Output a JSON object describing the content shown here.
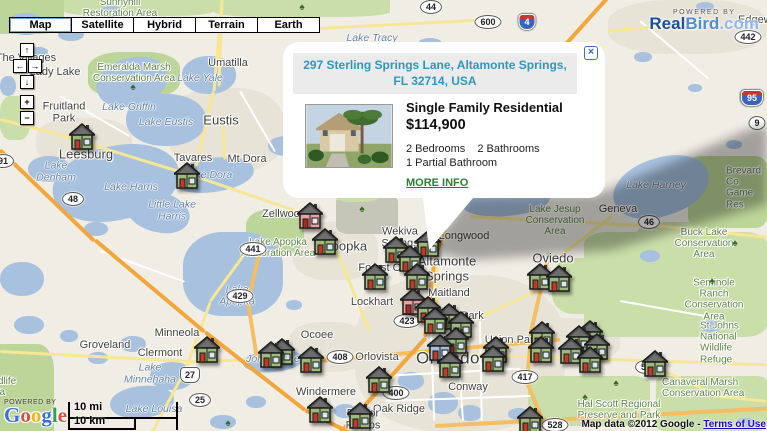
{
  "header": {
    "map_types": [
      "Map",
      "Satellite",
      "Hybrid",
      "Terrain",
      "Earth"
    ],
    "selected_map_type": "Map"
  },
  "controls": {
    "pan_up": "↑",
    "pan_left": "←",
    "pan_right": "→",
    "pan_down": "↓",
    "zoom_in": "+",
    "zoom_out": "−"
  },
  "infowindow": {
    "address": "297 Sterling Springs Lane, Altamonte Springs, FL 32714, USA",
    "close": "×",
    "property_type": "Single Family Residential",
    "price": "$114,900",
    "bedrooms": "2 Bedrooms",
    "bathrooms": "2 Bathrooms",
    "partial_bath": "1 Partial Bathroom",
    "more_info": "MORE INFO"
  },
  "branding": {
    "realbird": {
      "powered_by": "POWERED BY",
      "real": "Real",
      "bird": "Bird",
      "com": ".com"
    },
    "google": {
      "powered_by": "POWERED BY",
      "letters": [
        {
          "ch": "G",
          "color": "#3B6FD4"
        },
        {
          "ch": "o",
          "color": "#D95040"
        },
        {
          "ch": "o",
          "color": "#F2B50F"
        },
        {
          "ch": "g",
          "color": "#3B6FD4"
        },
        {
          "ch": "l",
          "color": "#30A055"
        },
        {
          "ch": "e",
          "color": "#D95040"
        }
      ]
    }
  },
  "scale": {
    "miles": "10 mi",
    "km": "10 km"
  },
  "attribution": {
    "text": "Map data ©2012 Google - ",
    "terms": "Terms of Use"
  },
  "map": {
    "labels": [
      {
        "text": "The Villages",
        "type": "city",
        "x": 26,
        "y": 58
      },
      {
        "text": "Sunnyhill\nRestoration Area",
        "type": "park",
        "x": 120,
        "y": 8
      },
      {
        "text": "Lady Lake",
        "type": "city",
        "x": 55,
        "y": 72
      },
      {
        "text": "Umatilla",
        "type": "city",
        "x": 228,
        "y": 63
      },
      {
        "text": "Emeralda Marsh\nConservation Area",
        "type": "park",
        "x": 134,
        "y": 73
      },
      {
        "text": "Lake Yale",
        "type": "water",
        "x": 200,
        "y": 79
      },
      {
        "text": "Lake Tracy",
        "type": "water",
        "x": 372,
        "y": 39
      },
      {
        "text": "Edgewater",
        "type": "city",
        "x": 738,
        "y": 20,
        "anchor": "left"
      },
      {
        "text": "Fruitland\nPark",
        "type": "city",
        "x": 64,
        "y": 113
      },
      {
        "text": "Lake Griffin",
        "type": "water",
        "x": 129,
        "y": 108
      },
      {
        "text": "Lake Eustis",
        "type": "water",
        "x": 166,
        "y": 123
      },
      {
        "text": "Eustis",
        "type": "city-big",
        "x": 221,
        "y": 121
      },
      {
        "text": "Leesburg",
        "type": "city-big",
        "x": 86,
        "y": 155
      },
      {
        "text": "Tavares",
        "type": "city",
        "x": 193,
        "y": 158
      },
      {
        "text": "Mt Dora",
        "type": "city",
        "x": 247,
        "y": 159
      },
      {
        "text": "Lake Dora",
        "type": "water",
        "x": 208,
        "y": 176
      },
      {
        "text": "Lake\nDenham",
        "type": "water",
        "x": 56,
        "y": 172
      },
      {
        "text": "Lake Harris",
        "type": "water",
        "x": 131,
        "y": 188
      },
      {
        "text": "Little Lake\nHarris",
        "type": "water",
        "x": 172,
        "y": 211
      },
      {
        "text": "Zellwood",
        "type": "city",
        "x": 284,
        "y": 214
      },
      {
        "text": "Lake Harney",
        "type": "water",
        "x": 656,
        "y": 186
      },
      {
        "text": "Geneva",
        "type": "city",
        "x": 618,
        "y": 209
      },
      {
        "text": "Lake Jesup\nConservation\nArea",
        "type": "park",
        "x": 555,
        "y": 221
      },
      {
        "text": "Brevard Co\nGame Res",
        "type": "park",
        "x": 726,
        "y": 188,
        "anchor": "left"
      },
      {
        "text": "Buck Lake\nConservation\nArea",
        "type": "park",
        "x": 704,
        "y": 244
      },
      {
        "text": "Wekiva\nSprings",
        "type": "city",
        "x": 400,
        "y": 238
      },
      {
        "text": "Longwood",
        "type": "city",
        "x": 464,
        "y": 236
      },
      {
        "text": "Apopka",
        "type": "city-big",
        "x": 345,
        "y": 247
      },
      {
        "text": "Lake Apopka\nRestoration Area",
        "type": "park",
        "x": 278,
        "y": 248
      },
      {
        "text": "Altamonte\nSprings",
        "type": "city-big",
        "x": 447,
        "y": 269
      },
      {
        "text": "Forest City",
        "type": "city",
        "x": 385,
        "y": 268
      },
      {
        "text": "Oviedo",
        "type": "city-big",
        "x": 553,
        "y": 259
      },
      {
        "text": "Lake\nApopka",
        "type": "water",
        "x": 237,
        "y": 296
      },
      {
        "text": "Maitland",
        "type": "city",
        "x": 449,
        "y": 293
      },
      {
        "text": "Lockhart",
        "type": "city",
        "x": 372,
        "y": 302
      },
      {
        "text": "Seminole Ranch\nConservation Area",
        "type": "park",
        "x": 714,
        "y": 300
      },
      {
        "text": "Winter Park",
        "type": "city",
        "x": 455,
        "y": 316
      },
      {
        "text": "Minneola",
        "type": "city",
        "x": 177,
        "y": 333
      },
      {
        "text": "Ocoee",
        "type": "city",
        "x": 317,
        "y": 335
      },
      {
        "text": "Union Park",
        "type": "city",
        "x": 512,
        "y": 340
      },
      {
        "text": "Bithlo",
        "type": "city",
        "x": 594,
        "y": 345
      },
      {
        "text": "St Johns National\nWildlife Refuge",
        "type": "park",
        "x": 700,
        "y": 343,
        "anchor": "left"
      },
      {
        "text": "Groveland",
        "type": "city",
        "x": 105,
        "y": 345
      },
      {
        "text": "Clermont",
        "type": "city",
        "x": 160,
        "y": 353
      },
      {
        "text": "Orlovista",
        "type": "city",
        "x": 377,
        "y": 357
      },
      {
        "text": "Orlando",
        "type": "city-huge",
        "x": 448,
        "y": 358
      },
      {
        "text": "Lake\nMinnehaha",
        "type": "water",
        "x": 150,
        "y": 374
      },
      {
        "text": "Johns Lake",
        "type": "water",
        "x": 273,
        "y": 360
      },
      {
        "text": "Windermere",
        "type": "city",
        "x": 326,
        "y": 392
      },
      {
        "text": "Conway",
        "type": "city",
        "x": 468,
        "y": 387
      },
      {
        "text": "Oak Ridge",
        "type": "city",
        "x": 399,
        "y": 409
      },
      {
        "text": "Doctor\nPhillips",
        "type": "city",
        "x": 363,
        "y": 420
      },
      {
        "text": "Lake Louisa",
        "type": "water",
        "x": 154,
        "y": 410
      },
      {
        "text": "Hal Scott Regional\nPreserve and Park",
        "type": "park",
        "x": 619,
        "y": 410
      },
      {
        "text": "Canaveral Marsh\nConservation Area",
        "type": "park",
        "x": 662,
        "y": 388,
        "anchor": "left"
      },
      {
        "text": "Wildlife\nArea",
        "type": "park",
        "x": -16,
        "y": 387,
        "anchor": "left"
      }
    ],
    "shields": [
      {
        "label": "44",
        "kind": "oval",
        "x": 431,
        "y": 7
      },
      {
        "label": "600",
        "kind": "oval",
        "x": 488,
        "y": 22
      },
      {
        "label": "4",
        "kind": "interstate",
        "x": 527,
        "y": 22
      },
      {
        "label": "442",
        "kind": "oval",
        "x": 748,
        "y": 37
      },
      {
        "label": "95",
        "kind": "interstate",
        "x": 752,
        "y": 98
      },
      {
        "label": "9",
        "kind": "oval",
        "x": 757,
        "y": 123
      },
      {
        "label": "91",
        "kind": "oval",
        "x": 3,
        "y": 161
      },
      {
        "label": "48",
        "kind": "oval",
        "x": 73,
        "y": 199
      },
      {
        "label": "441",
        "kind": "oval",
        "x": 253,
        "y": 249
      },
      {
        "label": "429",
        "kind": "oval",
        "x": 240,
        "y": 296
      },
      {
        "label": "46",
        "kind": "oval",
        "x": 649,
        "y": 222
      },
      {
        "label": "423",
        "kind": "oval",
        "x": 407,
        "y": 321
      },
      {
        "label": "408",
        "kind": "oval",
        "x": 340,
        "y": 357
      },
      {
        "label": "417",
        "kind": "oval",
        "x": 525,
        "y": 377
      },
      {
        "label": "400",
        "kind": "oval",
        "x": 396,
        "y": 393
      },
      {
        "label": "27",
        "kind": "us",
        "x": 190,
        "y": 375
      },
      {
        "label": "25",
        "kind": "oval",
        "x": 200,
        "y": 400
      },
      {
        "label": "50",
        "kind": "oval",
        "x": 646,
        "y": 367
      },
      {
        "label": "528",
        "kind": "oval",
        "x": 555,
        "y": 425
      }
    ],
    "marker_colors": {
      "green": {
        "body": "#9CBA7C",
        "door": "#C0392B",
        "roof": "#565656",
        "win": "#D8E7F0"
      },
      "pink": {
        "body": "#E8A0A0",
        "door": "#A82828",
        "roof": "#565656",
        "win": "#F0E0E0"
      },
      "blue": {
        "body": "#9FC0DF",
        "door": "#C0392B",
        "roof": "#565656",
        "win": "#E8F0F8"
      }
    },
    "markers": [
      {
        "x": 82,
        "y": 137,
        "v": "green"
      },
      {
        "x": 187,
        "y": 176,
        "v": "green"
      },
      {
        "x": 310,
        "y": 216,
        "v": "pink"
      },
      {
        "x": 325,
        "y": 242,
        "v": "green"
      },
      {
        "x": 396,
        "y": 250,
        "v": "green"
      },
      {
        "x": 410,
        "y": 259,
        "v": "green"
      },
      {
        "x": 428,
        "y": 244,
        "v": "green"
      },
      {
        "x": 375,
        "y": 277,
        "v": "green"
      },
      {
        "x": 417,
        "y": 277,
        "v": "green"
      },
      {
        "x": 540,
        "y": 277,
        "v": "green"
      },
      {
        "x": 559,
        "y": 279,
        "v": "green"
      },
      {
        "x": 413,
        "y": 302,
        "v": "pink"
      },
      {
        "x": 428,
        "y": 310,
        "v": "green"
      },
      {
        "x": 449,
        "y": 317,
        "v": "green"
      },
      {
        "x": 435,
        "y": 321,
        "v": "green"
      },
      {
        "x": 461,
        "y": 325,
        "v": "green"
      },
      {
        "x": 456,
        "y": 341,
        "v": "green"
      },
      {
        "x": 440,
        "y": 348,
        "v": "blue"
      },
      {
        "x": 450,
        "y": 365,
        "v": "green"
      },
      {
        "x": 496,
        "y": 350,
        "v": "green"
      },
      {
        "x": 493,
        "y": 359,
        "v": "green"
      },
      {
        "x": 542,
        "y": 335,
        "v": "green"
      },
      {
        "x": 541,
        "y": 350,
        "v": "green"
      },
      {
        "x": 579,
        "y": 339,
        "v": "green"
      },
      {
        "x": 590,
        "y": 334,
        "v": "green"
      },
      {
        "x": 571,
        "y": 351,
        "v": "green"
      },
      {
        "x": 597,
        "y": 347,
        "v": "green"
      },
      {
        "x": 590,
        "y": 360,
        "v": "green"
      },
      {
        "x": 655,
        "y": 364,
        "v": "green"
      },
      {
        "x": 207,
        "y": 350,
        "v": "green"
      },
      {
        "x": 282,
        "y": 352,
        "v": "green"
      },
      {
        "x": 271,
        "y": 355,
        "v": "green"
      },
      {
        "x": 311,
        "y": 360,
        "v": "green"
      },
      {
        "x": 379,
        "y": 380,
        "v": "green"
      },
      {
        "x": 320,
        "y": 410,
        "v": "green"
      },
      {
        "x": 360,
        "y": 416,
        "v": "green"
      },
      {
        "x": 530,
        "y": 420,
        "v": "green"
      }
    ],
    "trees": [
      {
        "x": 133,
        "y": 88
      },
      {
        "x": 362,
        "y": 210
      },
      {
        "x": 735,
        "y": 244
      },
      {
        "x": 712,
        "y": 282
      },
      {
        "x": 616,
        "y": 384
      },
      {
        "x": 228,
        "y": 424
      },
      {
        "x": 302,
        "y": 8
      },
      {
        "x": 585,
        "y": 398
      }
    ]
  }
}
